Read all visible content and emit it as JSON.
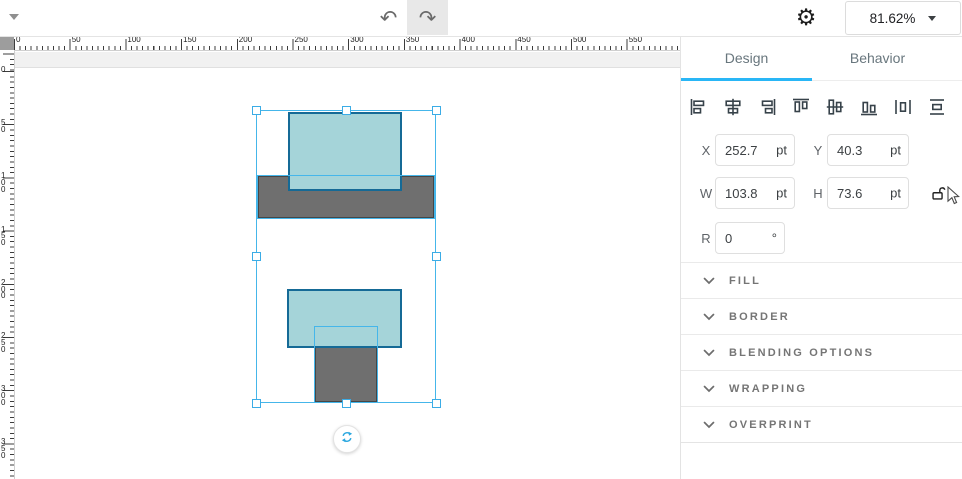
{
  "topbar": {
    "undo_glyph": "↶",
    "redo_glyph": "↷",
    "settings_glyph": "⚙",
    "zoom_control": {
      "value": "81.62%"
    }
  },
  "panel": {
    "tabs": [
      {
        "label": "Design"
      },
      {
        "label": "Behavior"
      }
    ],
    "align_tools": [
      "align-left",
      "align-center-horizontal",
      "align-right",
      "align-top",
      "align-middle-vertical",
      "align-bottom",
      "distribute-horizontal",
      "distribute-vertical"
    ],
    "transform": {
      "x_label": "X",
      "x_value": "252.7",
      "x_unit": "pt",
      "y_label": "Y",
      "y_value": "40.3",
      "y_unit": "pt",
      "w_label": "W",
      "w_value": "103.8",
      "w_unit": "pt",
      "h_label": "H",
      "h_value": "73.6",
      "h_unit": "pt",
      "r_label": "R",
      "r_value": "0",
      "r_unit": "°"
    },
    "sections": [
      {
        "label": "FILL"
      },
      {
        "label": "BORDER"
      },
      {
        "label": "BLENDING OPTIONS"
      },
      {
        "label": "WRAPPING"
      },
      {
        "label": "OVERPRINT"
      }
    ]
  },
  "rulers": {
    "horizontal_labels": [
      "0",
      "50",
      "100",
      "150",
      "200",
      "250",
      "300",
      "350",
      "400",
      "450",
      "500",
      "550",
      "600"
    ],
    "vertical_labels": [
      "0",
      "50",
      "100",
      "150",
      "200",
      "250",
      "300",
      "350"
    ]
  },
  "canvas": {
    "shapes": [
      {
        "name": "upper-gray-rectangle",
        "x": 257,
        "y": 175,
        "w": 178,
        "h": 44,
        "fill": "#6f6f6f",
        "border": "#464646",
        "highlight": true
      },
      {
        "name": "upper-teal-rectangle",
        "x": 288,
        "y": 112,
        "w": 114,
        "h": 79,
        "fill": "#a5d4d9",
        "border": "#156a96",
        "highlight": false
      },
      {
        "name": "lower-gray-rectangle",
        "x": 314,
        "y": 326,
        "w": 64,
        "h": 77,
        "fill": "#6f6f6f",
        "border": "#464646",
        "highlight": true
      },
      {
        "name": "lower-teal-rectangle",
        "x": 287,
        "y": 289,
        "w": 115,
        "h": 59,
        "fill": "#a5d4d9",
        "border": "#156a96",
        "highlight": false
      }
    ],
    "selection": {
      "x": 256,
      "y": 110,
      "w": 180,
      "h": 293,
      "color": "#45b6ea"
    }
  },
  "colors": {
    "accent_blue": "#29b6f6",
    "selection_blue": "#45b6ea",
    "teal_fill": "#a5d4d9",
    "teal_border": "#156a96",
    "shape_gray": "#6f6f6f"
  }
}
